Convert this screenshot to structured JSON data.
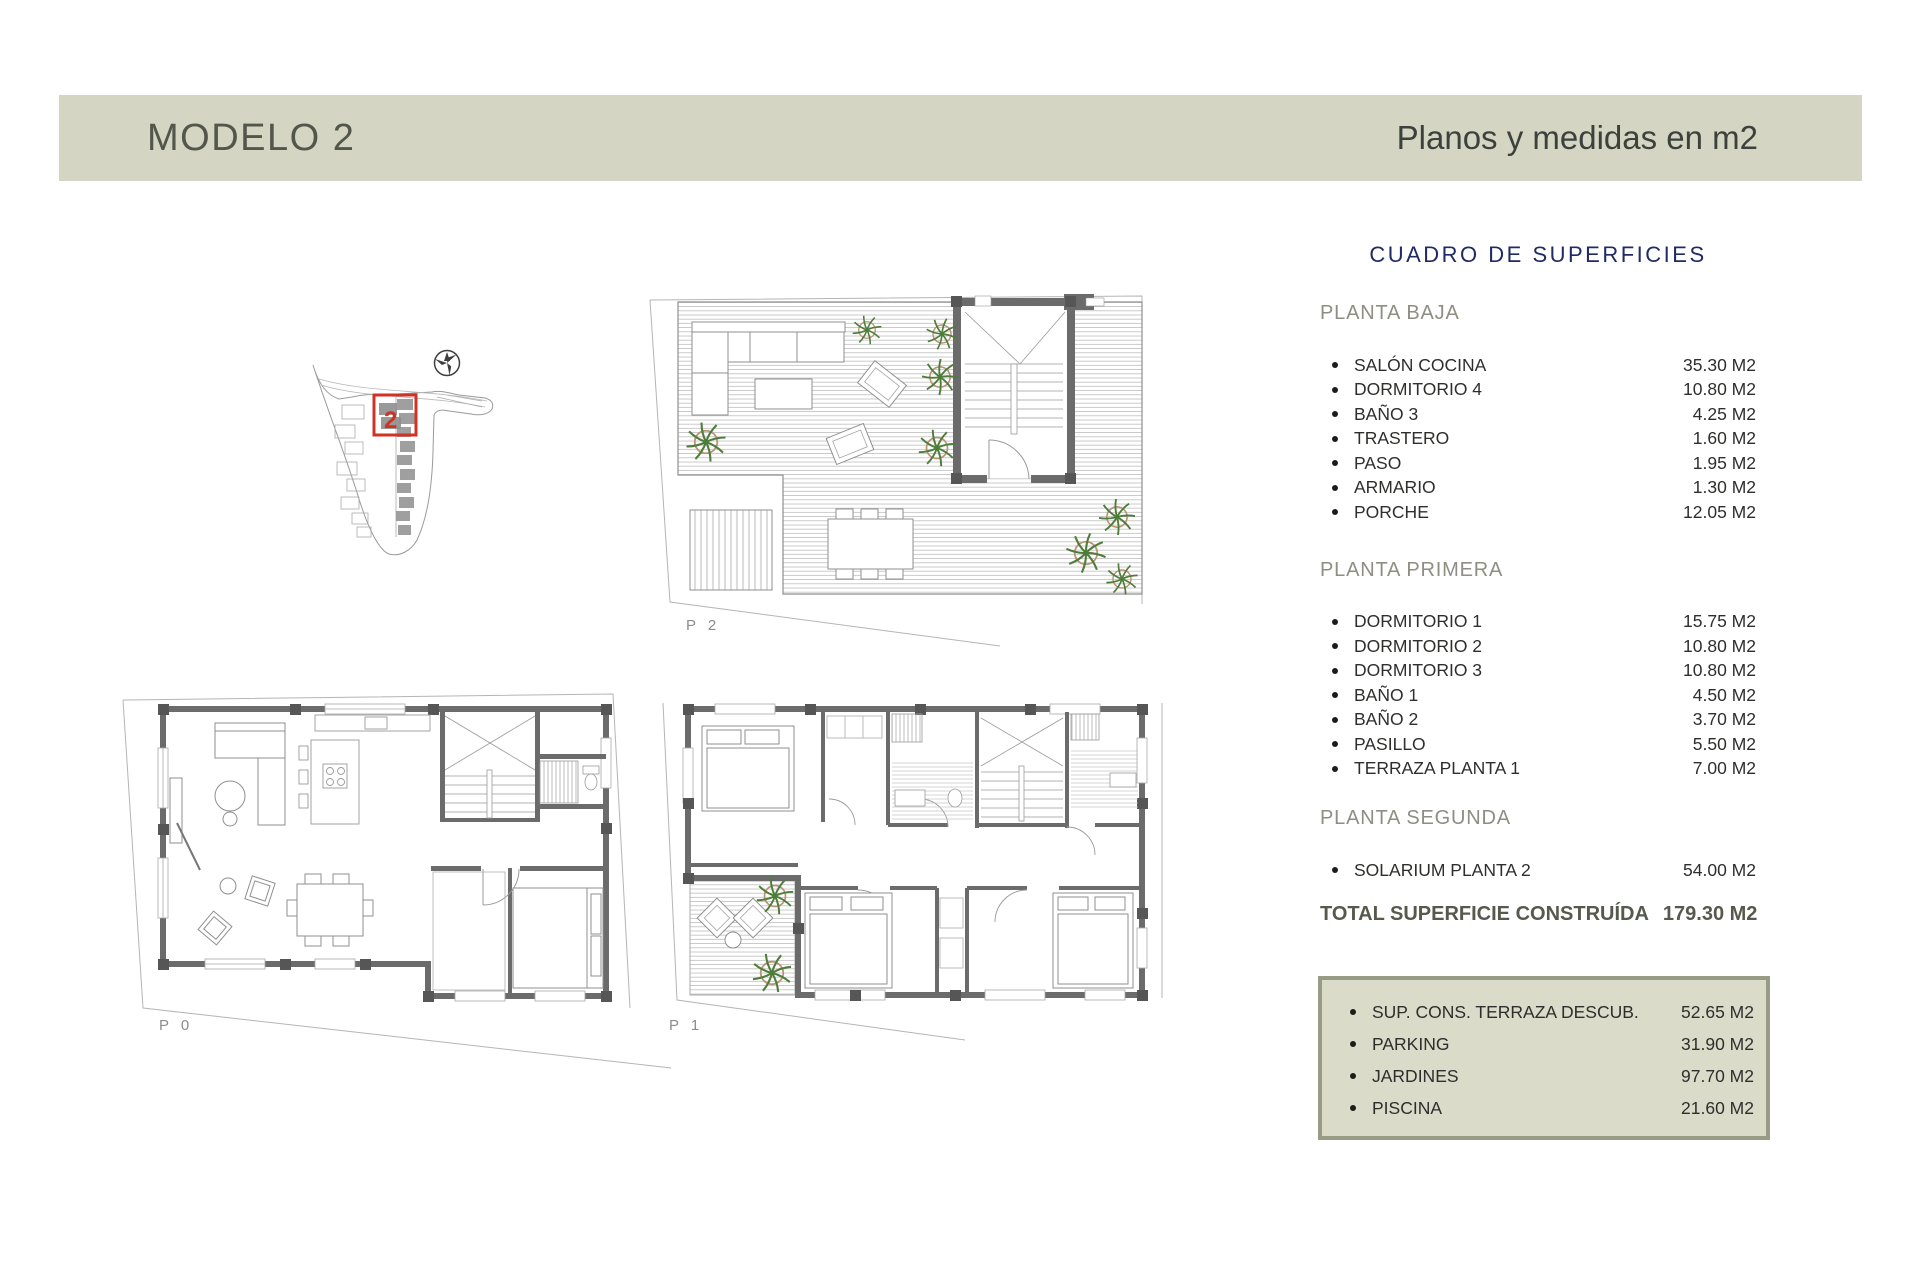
{
  "header": {
    "title": "MODELO 2",
    "subtitle": "Planos y medidas en m2"
  },
  "surfaces": {
    "title": "CUADRO DE SUPERFICIES",
    "sections": [
      {
        "name": "PLANTA BAJA",
        "items": [
          {
            "label": "SALÓN COCINA",
            "value": "35.30 M2"
          },
          {
            "label": "DORMITORIO 4",
            "value": "10.80 M2"
          },
          {
            "label": "BAÑO 3",
            "value": "4.25 M2"
          },
          {
            "label": "TRASTERO",
            "value": "1.60 M2"
          },
          {
            "label": "PASO",
            "value": "1.95 M2"
          },
          {
            "label": "ARMARIO",
            "value": "1.30 M2"
          },
          {
            "label": "PORCHE",
            "value": "12.05 M2"
          }
        ]
      },
      {
        "name": "PLANTA PRIMERA",
        "items": [
          {
            "label": "DORMITORIO 1",
            "value": "15.75 M2"
          },
          {
            "label": "DORMITORIO 2",
            "value": "10.80 M2"
          },
          {
            "label": "DORMITORIO 3",
            "value": "10.80 M2"
          },
          {
            "label": "BAÑO 1",
            "value": "4.50 M2"
          },
          {
            "label": "BAÑO 2",
            "value": "3.70 M2"
          },
          {
            "label": "PASILLO",
            "value": "5.50 M2"
          },
          {
            "label": "TERRAZA PLANTA 1",
            "value": "7.00 M2"
          }
        ]
      },
      {
        "name": "PLANTA SEGUNDA",
        "items": [
          {
            "label": "SOLARIUM PLANTA 2",
            "value": "54.00 M2"
          }
        ]
      }
    ],
    "total": {
      "label": "TOTAL SUPERFICIE CONSTRUÍDA",
      "value": "179.30 M2"
    },
    "extras": {
      "items": [
        {
          "label": "SUP. CONS. TERRAZA DESCUB.",
          "value": "52.65 M2"
        },
        {
          "label": "PARKING",
          "value": "31.90 M2"
        },
        {
          "label": "JARDINES",
          "value": "97.70 M2"
        },
        {
          "label": "PISCINA",
          "value": "21.60 M2"
        }
      ]
    }
  },
  "plans": {
    "p2_label": "P 2",
    "p0_label": "P 0",
    "p1_label": "P 1",
    "site_unit_number": "2"
  },
  "colors": {
    "header_bg": "#d4d5c3",
    "title_navy": "#202a63",
    "heading_gray": "#8e8e82",
    "text_dark": "#2e2e2c",
    "total_green_gray": "#565a4c",
    "accent_red": "#d03226",
    "box_bg": "#dadbc9",
    "box_border": "#989c85",
    "wall_gray": "#6b6b6b",
    "plant_green": "#4e7d3a"
  }
}
